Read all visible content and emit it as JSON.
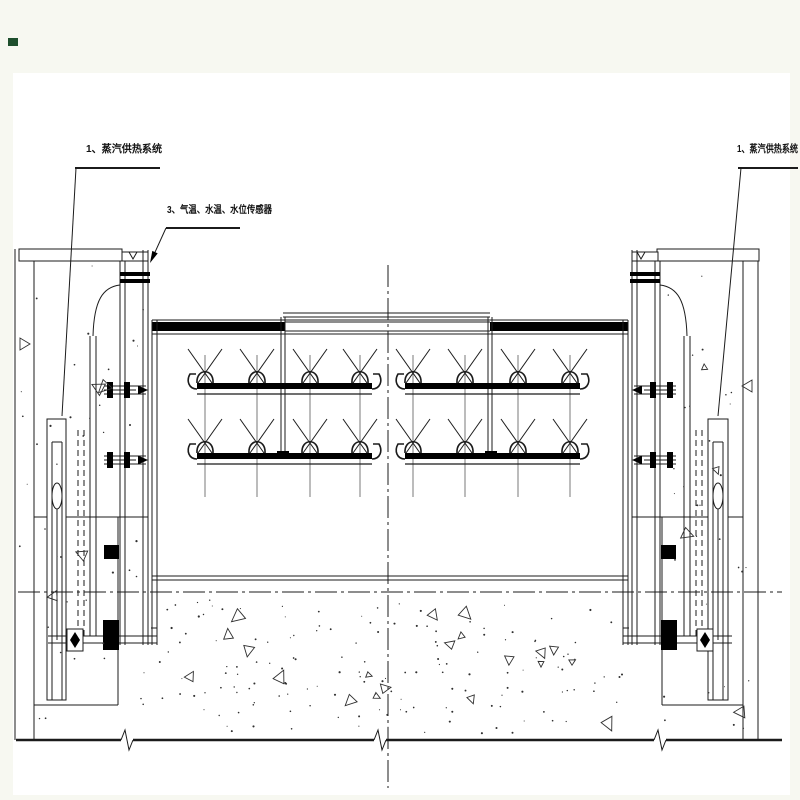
{
  "colors": {
    "page_bg": "#f7f8f1",
    "paper": "#ffffff",
    "ink": "#1b1b1b",
    "ink_heavy": "#000000",
    "texture_ink": "#2f2f2f",
    "corner_mark": "#1e4f2d"
  },
  "labels": {
    "steam_left": "1、蒸汽供热系统",
    "steam_right": "1、蒸汽供热系统",
    "sensors": "3、气温、水温、水位传感器"
  }
}
